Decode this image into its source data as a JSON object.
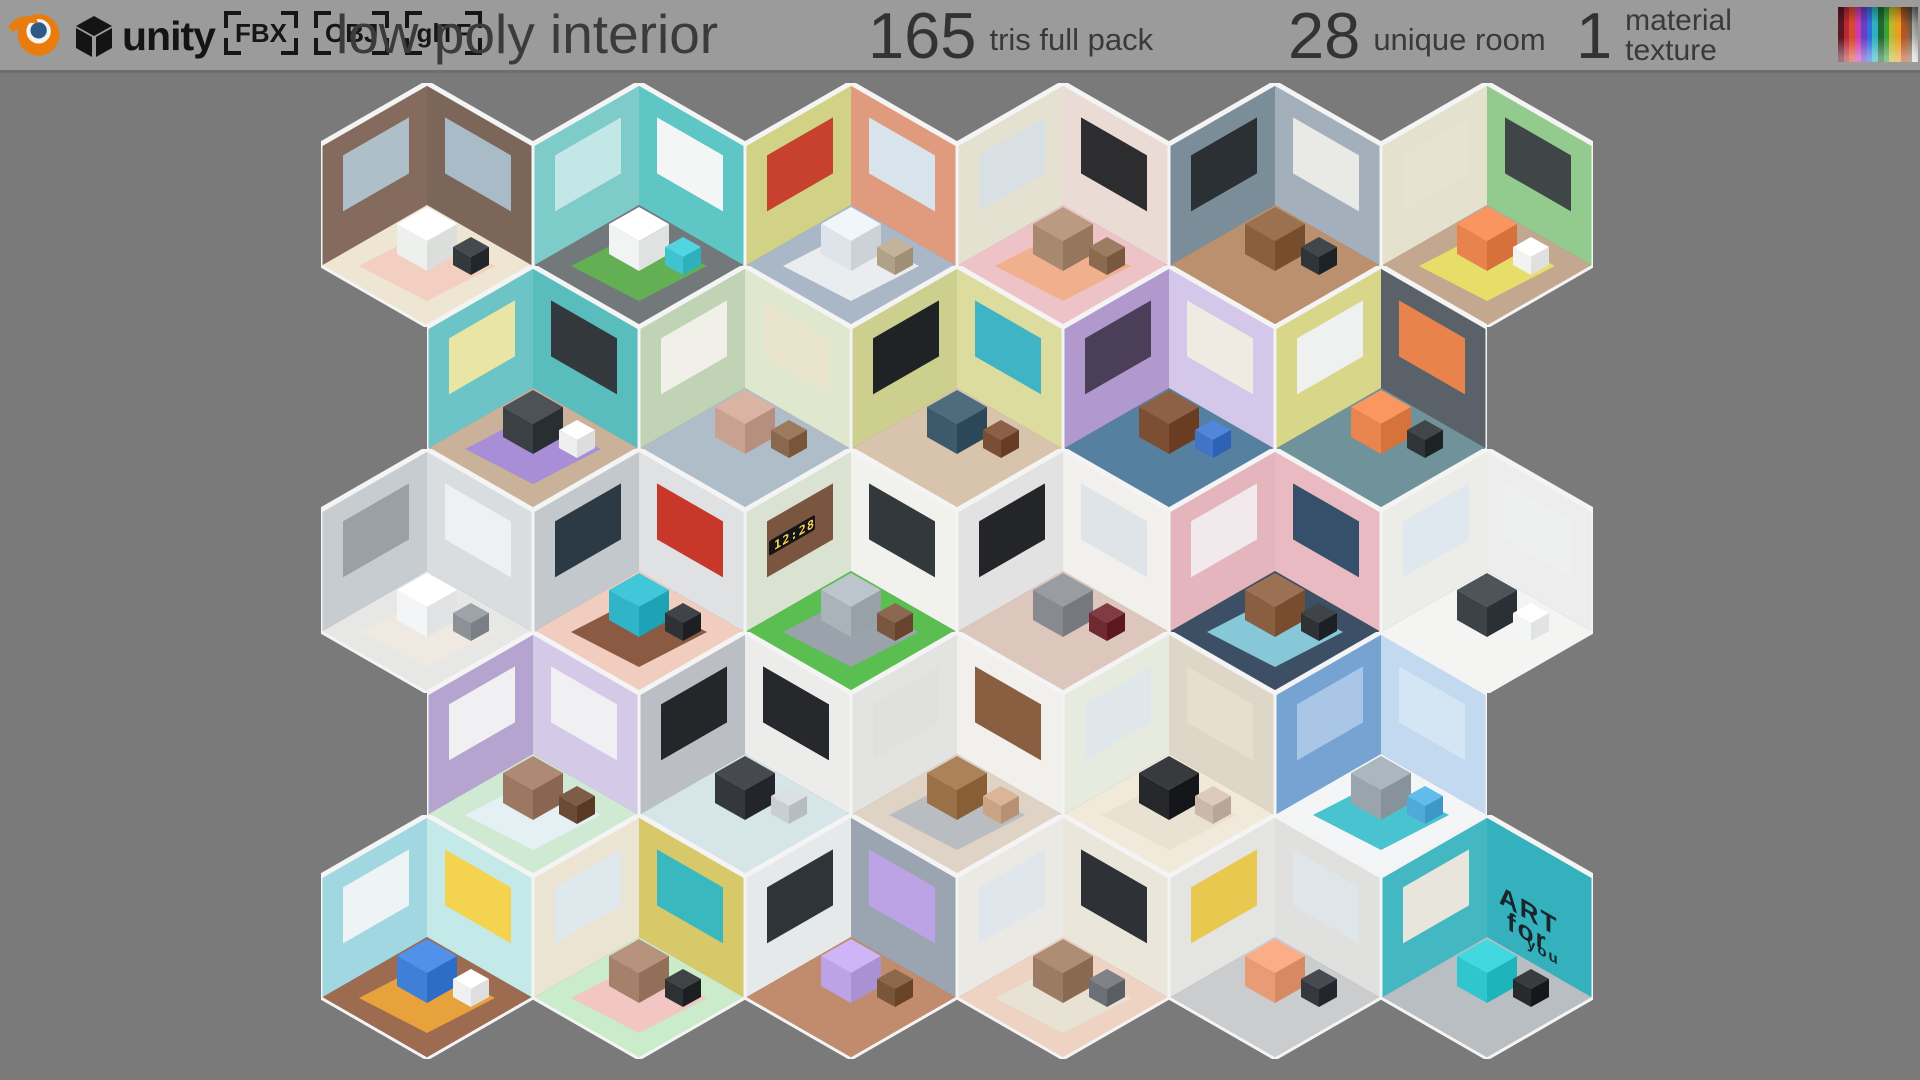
{
  "page": {
    "background": "#7a7a7a"
  },
  "header": {
    "background": "#9b9b9b",
    "text_color": "#3a3a3a",
    "blender_icon": "blender-logo",
    "unity_label": "unity",
    "formats": [
      "FBX",
      "OBJ",
      "glTF"
    ],
    "title": "low poly interior",
    "stats": [
      {
        "value": "165",
        "label": "tris full pack"
      },
      {
        "value": "28",
        "label": "unique room"
      },
      {
        "value": "1",
        "label": "material texture"
      }
    ],
    "palette_colors": [
      "#5e1620",
      "#b82836",
      "#d84a28",
      "#cc3aa8",
      "#6a3cc8",
      "#2f6fd8",
      "#2fb0c0",
      "#1d6b33",
      "#3da03c",
      "#bdb92e",
      "#e8a01e",
      "#b85524",
      "#8a6a4c",
      "#d8d8d6"
    ]
  },
  "grid": {
    "origin_x": 321,
    "origin_y": 83,
    "tile_w": 212,
    "tile_h": 244,
    "row_pitch": 183,
    "trim_color": "#f4f4f4",
    "rows": [
      {
        "offset": 0,
        "rooms": [
          {
            "id": "living-room",
            "wall_l": "#8a7163",
            "wall_r": "#7c665a",
            "floor": "#efe5d3",
            "rug": "#f2cfc0",
            "box": "#eef0ee",
            "box2": "#33383c",
            "panel_l": "#aebfc9",
            "panel_r": "#a9bbc7",
            "wall_text": null
          },
          {
            "id": "laundromat",
            "wall_l": "#84d2d0",
            "wall_r": "#5fc6c6",
            "floor": "#73787b",
            "rug": "#62b053",
            "box": "#f2f4f4",
            "box2": "#3ec3cf",
            "panel_l": "#c3e6e6",
            "panel_r": "#f4f6f6",
            "wall_text": null
          },
          {
            "id": "bedroom-tv",
            "wall_l": "#d7d88c",
            "wall_r": "#e09a7d",
            "floor": "#aab7c6",
            "rug": "#e9edef",
            "box": "#dfe3ea",
            "box2": "#b2a189",
            "panel_l": "#c8402e",
            "panel_r": "#d9e3eb",
            "wall_text": null
          },
          {
            "id": "cafe",
            "wall_l": "#ebe7d7",
            "wall_r": "#eadbd5",
            "floor": "#eec3c7",
            "rug": "#f0b08e",
            "box": "#a8896f",
            "box2": "#8a6a50",
            "panel_l": "#d8e0e4",
            "panel_r": "#2d2d2f",
            "wall_text": null
          },
          {
            "id": "office",
            "wall_l": "#80939f",
            "wall_r": "#a3afbb",
            "floor": "#ba906f",
            "rug": null,
            "box": "#8a5f3d",
            "box2": "#2e3438",
            "panel_l": "#2b3034",
            "panel_r": "#e9e9e5",
            "wall_text": null
          },
          {
            "id": "hostel-bedroom",
            "wall_l": "#eae7d4",
            "wall_r": "#93ca8d",
            "floor": "#c3a78f",
            "rug": "#e6de69",
            "box": "#e8834d",
            "box2": "#f2f2f0",
            "panel_l": "#e7e3d0",
            "panel_r": "#3f4648",
            "wall_text": null
          }
        ]
      },
      {
        "offset": 106,
        "rooms": [
          {
            "id": "kitchen-dining",
            "wall_l": "#72cacc",
            "wall_r": "#5abdbd",
            "floor": "#c9b299",
            "rug": "#a78ed6",
            "box": "#3b4045",
            "box2": "#eef0f0",
            "panel_l": "#e9e5a4",
            "panel_r": "#33383c",
            "wall_text": null
          },
          {
            "id": "green-living-room",
            "wall_l": "#c6d9ba",
            "wall_r": "#dfe7cf",
            "floor": "#aebdc8",
            "rug": null,
            "box": "#c9a190",
            "box2": "#8a684c",
            "panel_l": "#f0efe8",
            "panel_r": "#e9e4cc",
            "wall_text": null
          },
          {
            "id": "tv-lounge",
            "wall_l": "#d3d594",
            "wall_r": "#dcdc9e",
            "floor": "#d8c3ad",
            "rug": null,
            "box": "#3d5a6a",
            "box2": "#7a4e34",
            "panel_l": "#1f2326",
            "panel_r": "#3fb4c4",
            "wall_text": null
          },
          {
            "id": "study-telescope",
            "wall_l": "#b79fd3",
            "wall_r": "#d5c7e9",
            "floor": "#56809f",
            "rug": null,
            "box": "#7c4f34",
            "box2": "#3f74c8",
            "panel_l": "#4a3e58",
            "panel_r": "#efeae2",
            "wall_text": null
          },
          {
            "id": "studio-apartment",
            "wall_l": "#dedc8f",
            "wall_r": "#5a6168",
            "floor": "#6f929b",
            "rug": null,
            "box": "#e8844e",
            "box2": "#2f3437",
            "panel_l": "#eff1f1",
            "panel_r": "#e8834b",
            "wall_text": null
          }
        ]
      },
      {
        "offset": 0,
        "rooms": [
          {
            "id": "white-bedroom",
            "wall_l": "#ccd2d6",
            "wall_r": "#d9dde0",
            "floor": "#e7e7e5",
            "rug": "#efe9e2",
            "box": "#f4f5f6",
            "box2": "#8b9197",
            "panel_l": "#9aa0a6",
            "panel_r": "#eef0f2",
            "wall_text": null
          },
          {
            "id": "art-studio",
            "wall_l": "#c9ced2",
            "wall_r": "#dfe1e3",
            "floor": "#f0cdbf",
            "rug": "#8a5a42",
            "box": "#2fb4c8",
            "box2": "#2e3236",
            "panel_l": "#2b3a44",
            "panel_r": "#c8382a",
            "wall_text": null
          },
          {
            "id": "zen-bedroom",
            "wall_l": "#e0e9d7",
            "wall_r": "#f1f1ed",
            "floor": "#5abf50",
            "rug": "#9aa2ab",
            "box": "#aab2ba",
            "box2": "#7a5640",
            "panel_l": "#7a5640",
            "panel_r": "#33383c",
            "wall_text": {
              "text": "12:28",
              "side": "left",
              "color": "#ffd34e",
              "bg": "#141518"
            }
          },
          {
            "id": "music-lounge",
            "wall_l": "#e8e8e8",
            "wall_r": "#f1f0ec",
            "floor": "#ddc7bd",
            "rug": null,
            "box": "#878a8f",
            "box2": "#6e2a30",
            "panel_l": "#232528",
            "panel_r": "#dfe4e8",
            "wall_text": null
          },
          {
            "id": "library",
            "wall_l": "#eabbc3",
            "wall_r": "#e9bac2",
            "floor": "#3d4f65",
            "rug": "#86c8d8",
            "box": "#8a5f41",
            "box2": "#2e3236",
            "panel_l": "#f2e9ec",
            "panel_r": "#36506b",
            "wall_text": null
          },
          {
            "id": "white-kitchen",
            "wall_l": "#f2f2ef",
            "wall_r": "#ededee",
            "floor": "#f4f4f2",
            "rug": null,
            "box": "#3c4248",
            "box2": "#f4f5f5",
            "panel_l": "#dfe8ee",
            "panel_r": "#eef0f0",
            "wall_text": null
          }
        ]
      },
      {
        "offset": 106,
        "rooms": [
          {
            "id": "family-living-room",
            "wall_l": "#bcaad6",
            "wall_r": "#d5c9e8",
            "floor": "#cfe9d2",
            "rug": "#e4f0f4",
            "box": "#9c7862",
            "box2": "#6b4a36",
            "panel_l": "#f0eff2",
            "panel_r": "#f0eff2",
            "wall_text": null
          },
          {
            "id": "vinyl-music-room",
            "wall_l": "#c1c5cb",
            "wall_r": "#ececea",
            "floor": "#d6e5e7",
            "rug": null,
            "box": "#34383c",
            "box2": "#c9ced4",
            "panel_l": "#24262a",
            "panel_r": "#26282c",
            "wall_text": null
          },
          {
            "id": "home-office",
            "wall_l": "#e9e9e7",
            "wall_r": "#f1f0ec",
            "floor": "#dfd3c5",
            "rug": "#b9bdc1",
            "box": "#9a7049",
            "box2": "#caa385",
            "panel_l": "#e0e0de",
            "panel_r": "#8a5f41",
            "wall_text": null
          },
          {
            "id": "piano-room",
            "wall_l": "#edf0e4",
            "wall_r": "#ded6c6",
            "floor": "#f1eadb",
            "rug": "#e9e2d2",
            "box": "#26282c",
            "box2": "#cab9ab",
            "panel_l": "#dfe7ea",
            "panel_r": "#e6dfd0",
            "wall_text": null
          },
          {
            "id": "bathroom",
            "wall_l": "#7da9d9",
            "wall_r": "#c3d9ef",
            "floor": "#f3f5f7",
            "rug": "#49c3cf",
            "box": "#9aa4ad",
            "box2": "#4fa9d9",
            "panel_l": "#a9c6e6",
            "panel_r": "#d4e6f4",
            "wall_text": null
          }
        ]
      },
      {
        "offset": 0,
        "rooms": [
          {
            "id": "kids-room",
            "wall_l": "#a7dde7",
            "wall_r": "#c3e9e9",
            "floor": "#9c6b50",
            "rug": "#e8a23c",
            "box": "#3f7fd8",
            "box2": "#f0f0f0",
            "panel_l": "#eef4f6",
            "panel_r": "#f4d44e",
            "wall_text": null
          },
          {
            "id": "cozy-living-room",
            "wall_l": "#f1ead9",
            "wall_r": "#d7c969",
            "floor": "#caecca",
            "rug": "#f2c6c2",
            "box": "#a5806b",
            "box2": "#2e3134",
            "panel_l": "#dfe8ec",
            "panel_r": "#3ab8c0",
            "wall_text": null
          },
          {
            "id": "purple-kitchen",
            "wall_l": "#eceff0",
            "wall_r": "#9ba5b2",
            "floor": "#c18b6e",
            "rug": null,
            "box": "#bba3e5",
            "box2": "#7b5538",
            "panel_l": "#2f3438",
            "panel_r": "#bba3e5",
            "wall_text": null
          },
          {
            "id": "tv-living-room",
            "wall_l": "#f1efe9",
            "wall_r": "#eae7da",
            "floor": "#eed3c3",
            "rug": "#e8e2d4",
            "box": "#9c7b63",
            "box2": "#6c7076",
            "panel_l": "#dfe7ec",
            "panel_r": "#2e3236",
            "wall_text": null
          },
          {
            "id": "home-gym",
            "wall_l": "#eaeae8",
            "wall_r": "#e0e1df",
            "floor": "#caccce",
            "rug": null,
            "box": "#e89b75",
            "box2": "#35393f",
            "panel_l": "#e8c84e",
            "panel_r": "#dfe6ea",
            "wall_text": null
          },
          {
            "id": "gamer-bedroom",
            "wall_l": "#49bec8",
            "wall_r": "#35b0bd",
            "floor": "#b9bec3",
            "rug": null,
            "box": "#2fc6ce",
            "box2": "#27292d",
            "panel_l": "#e8e6dc",
            "panel_r": null,
            "wall_text": {
              "text": "ART for you",
              "side": "right",
              "color": "#16262b",
              "bg": null
            }
          }
        ]
      }
    ]
  }
}
